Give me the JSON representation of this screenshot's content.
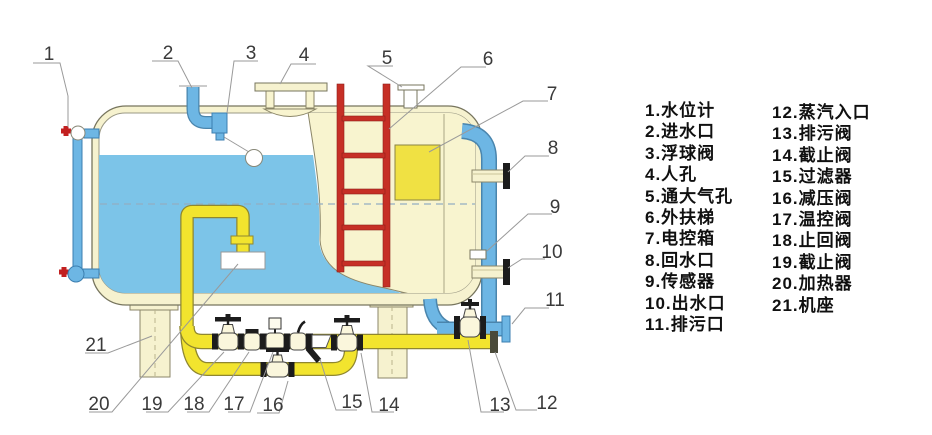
{
  "callouts": {
    "c1": "1",
    "c2": "2",
    "c3": "3",
    "c4": "4",
    "c5": "5",
    "c6": "6",
    "c7": "7",
    "c8": "8",
    "c9": "9",
    "c10": "10",
    "c11": "11",
    "c12": "12",
    "c13": "13",
    "c14": "14",
    "c15": "15",
    "c16": "16",
    "c17": "17",
    "c18": "18",
    "c19": "19",
    "c20": "20",
    "c21": "21"
  },
  "legend": {
    "col1": [
      "1.水位计",
      "2.进水口",
      "3.浮球阀",
      "4.人孔",
      "5.通大气孔",
      "6.外扶梯",
      "7.电控箱",
      "8.回水口",
      "9.传感器",
      "10.出水口",
      "11.排污口"
    ],
    "col2": [
      "12.蒸汽入口",
      "13.排污阀",
      "14.截止阀",
      "15.过滤器",
      "16.减压阀",
      "17.温控阀",
      "18.止回阀",
      "19.截止阀",
      "20.加热器",
      "21.机座"
    ]
  },
  "colors": {
    "water": "#7cc4e8",
    "shell_cream": "#f6f2cf",
    "pipe_yellow": "#f2e42e",
    "pipe_blue": "#6db6e4",
    "ladder_red": "#c62f26",
    "control_box": "#f0e143",
    "valve_black": "#1c1c1c",
    "leader_gray": "#9a9a9a"
  }
}
